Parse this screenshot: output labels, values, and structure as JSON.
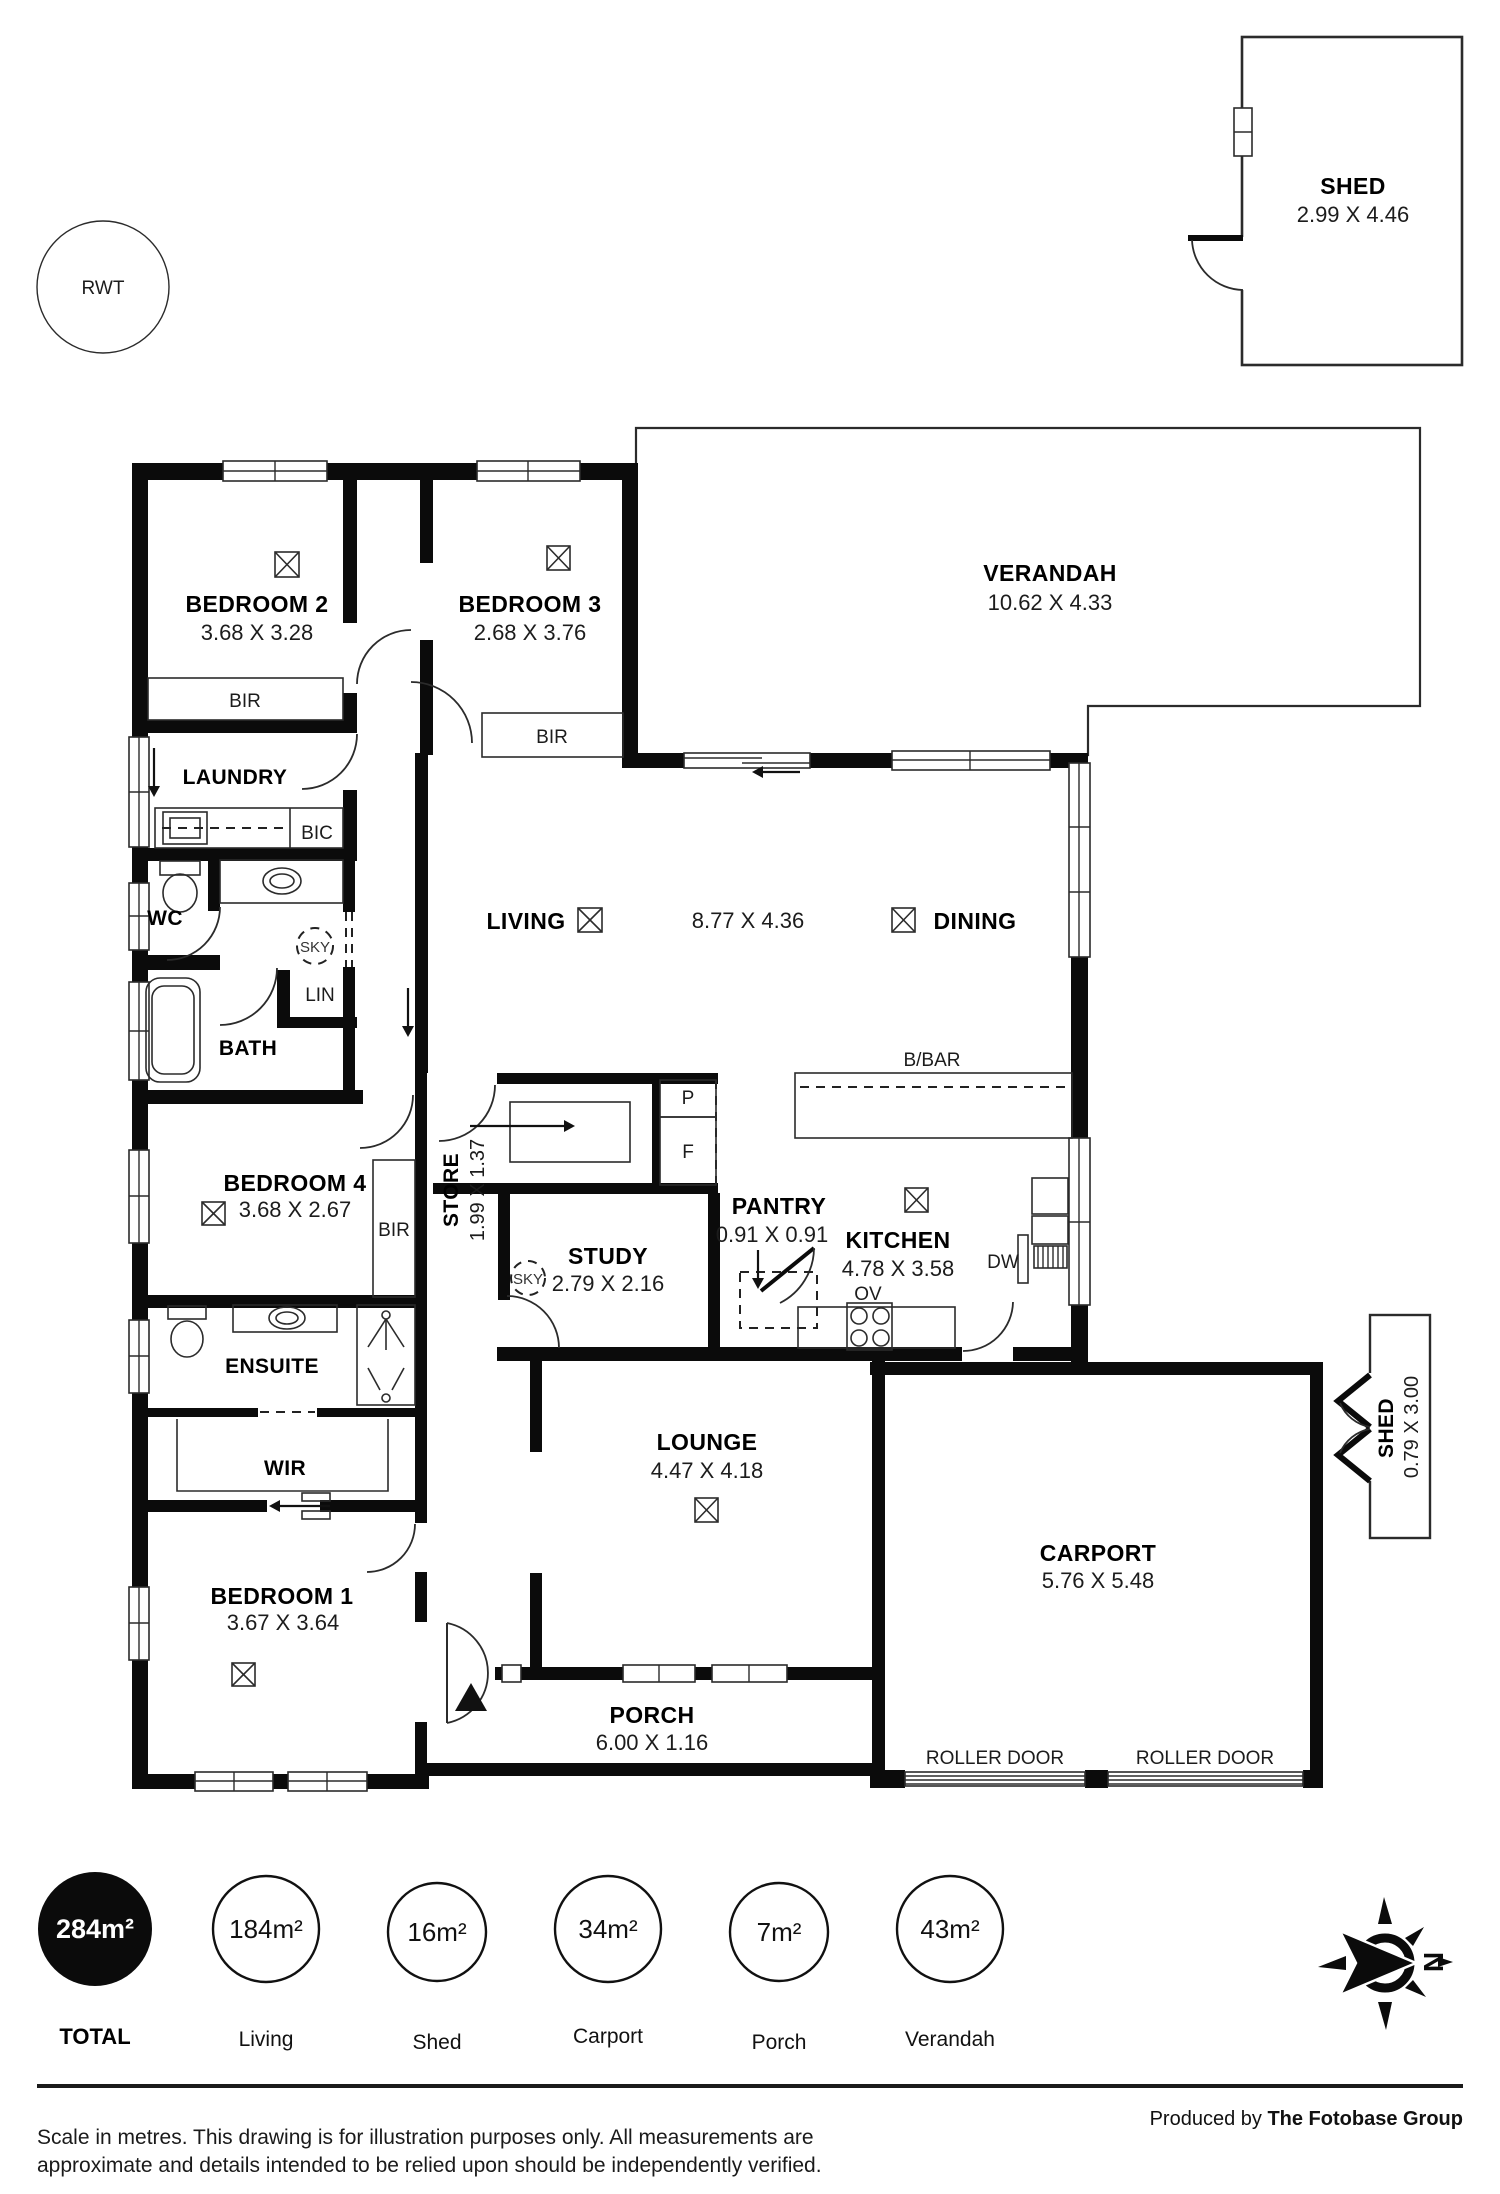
{
  "plan": {
    "rwt": {
      "label": "RWT"
    },
    "shedTop": {
      "name": "SHED",
      "dim": "2.99 X 4.46"
    },
    "shedSide": {
      "name": "SHED",
      "dim": "0.79 X 3.00"
    },
    "verandah": {
      "name": "VERANDAH",
      "dim": "10.62 X 4.33"
    },
    "bedroom2": {
      "name": "BEDROOM 2",
      "dim": "3.68 X 3.28"
    },
    "bedroom3": {
      "name": "BEDROOM 3",
      "dim": "2.68 X 3.76"
    },
    "laundry": {
      "name": "LAUNDRY"
    },
    "wc": {
      "name": "WC"
    },
    "bath": {
      "name": "BATH"
    },
    "living": {
      "name": "LIVING",
      "dim": "8.77 X 4.36"
    },
    "dining": {
      "name": "DINING"
    },
    "store": {
      "name": "STORE",
      "dim": "1.99 X 1.37"
    },
    "study": {
      "name": "STUDY",
      "dim": "2.79 X 2.16"
    },
    "pantry": {
      "name": "PANTRY",
      "dim": "0.91 X 0.91"
    },
    "kitchen": {
      "name": "KITCHEN",
      "dim": "4.78 X 3.58"
    },
    "bedroom4": {
      "name": "BEDROOM 4",
      "dim": "3.68 X 2.67"
    },
    "ensuite": {
      "name": "ENSUITE"
    },
    "wir": {
      "name": "WIR"
    },
    "bedroom1": {
      "name": "BEDROOM 1",
      "dim": "3.67 X 3.64"
    },
    "lounge": {
      "name": "LOUNGE",
      "dim": "4.47 X 4.18"
    },
    "porch": {
      "name": "PORCH",
      "dim": "6.00 X 1.16"
    },
    "carport": {
      "name": "CARPORT",
      "dim": "5.76 X 5.48"
    },
    "fix": {
      "bir": "BIR",
      "bic": "BIC",
      "lin": "LIN",
      "sky": "SKY",
      "bbar": "B/BAR",
      "p": "P",
      "f": "F",
      "ov": "OV",
      "dw": "DW",
      "roller": "ROLLER DOOR",
      "north": "N"
    }
  },
  "legend": {
    "items": [
      {
        "value": "284m²",
        "label": "TOTAL"
      },
      {
        "value": "184m²",
        "label": "Living"
      },
      {
        "value": "16m²",
        "label": "Shed"
      },
      {
        "value": "34m²",
        "label": "Carport"
      },
      {
        "value": "7m²",
        "label": "Porch"
      },
      {
        "value": "43m²",
        "label": "Verandah"
      }
    ]
  },
  "footer": {
    "line1": "Scale in metres. This drawing is for illustration purposes only. All measurements are",
    "line2": "approximate and details intended to be relied upon should be independently verified.",
    "producedPrefix": "Produced by ",
    "producedBrand": "The Fotobase Group"
  }
}
